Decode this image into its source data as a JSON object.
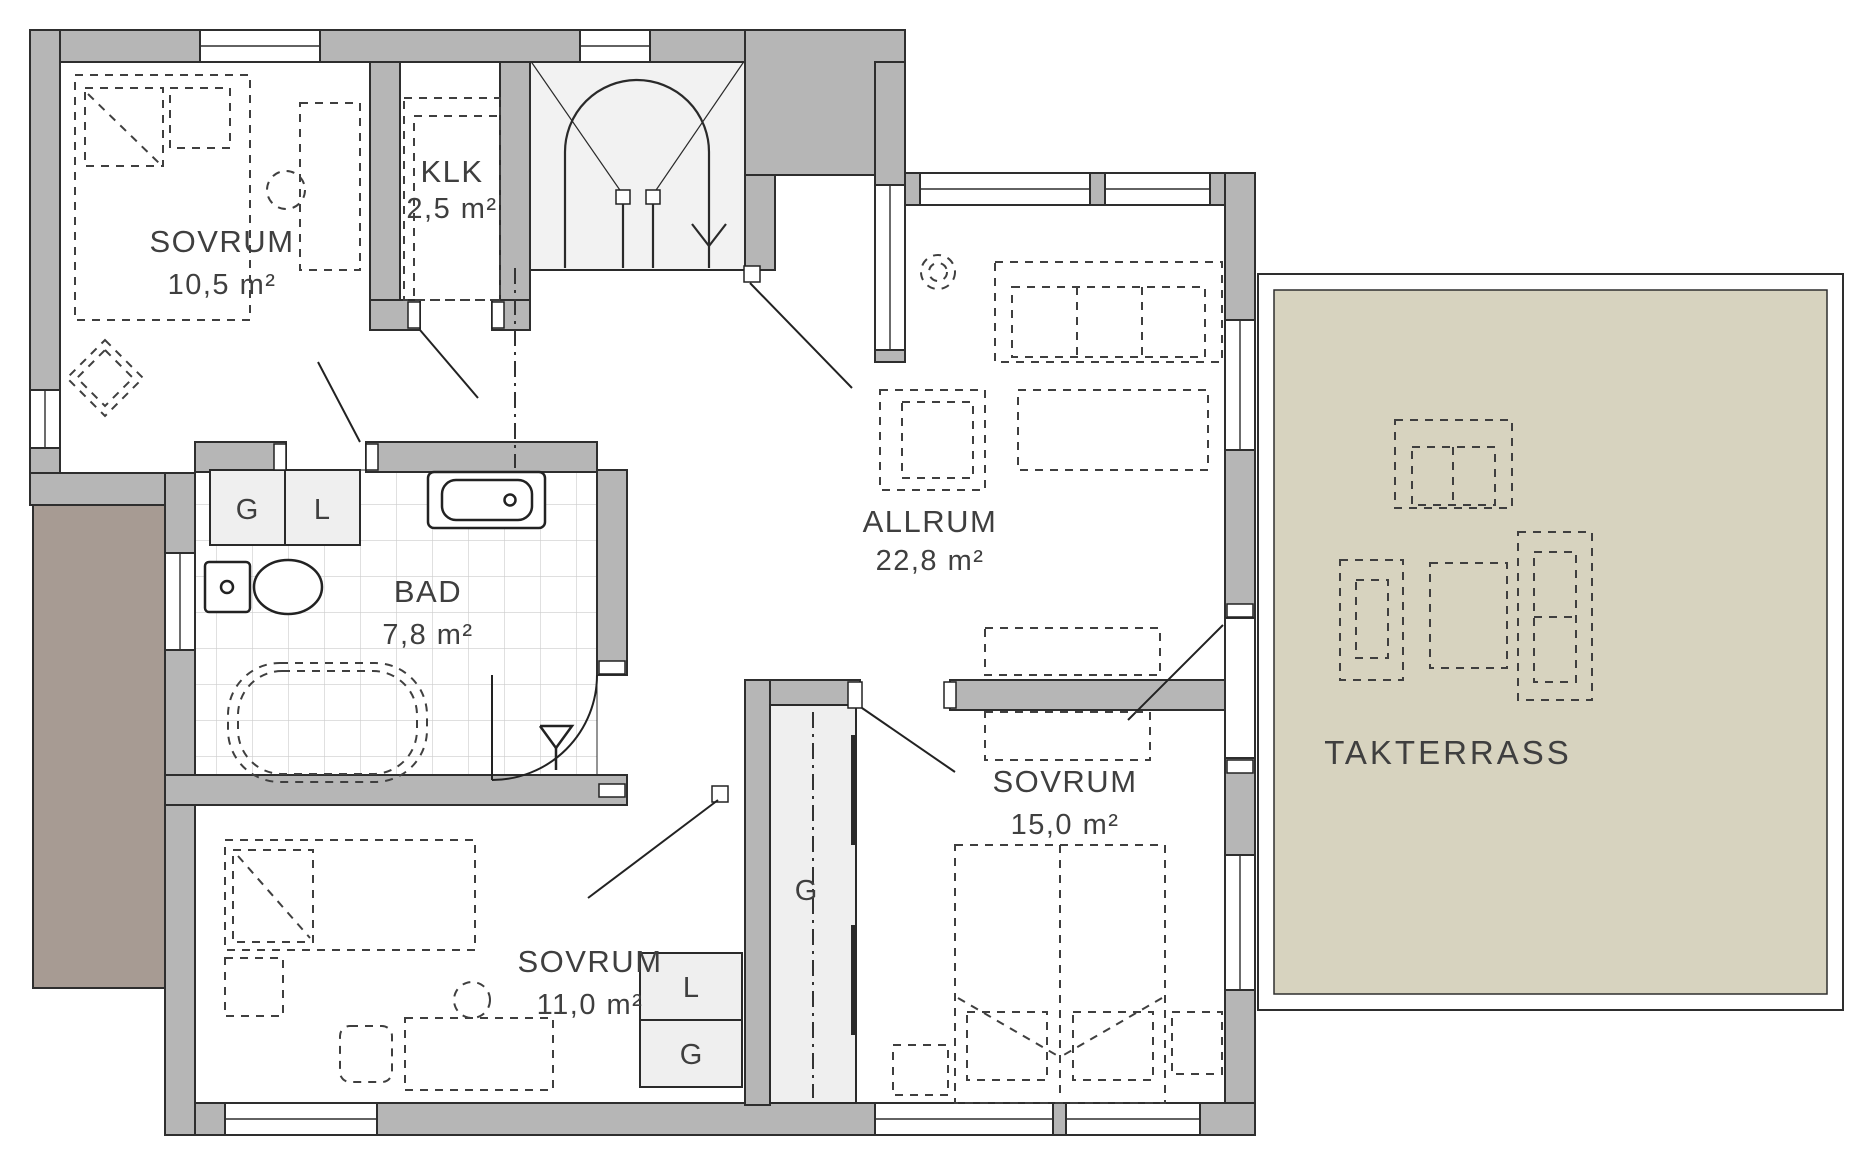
{
  "plan_title": "Floor plan, upper storey",
  "rooms": {
    "bedroom_top": {
      "name": "SOVRUM",
      "area": "10,5 m²"
    },
    "klk": {
      "name": "KLK",
      "area": "2,5 m²"
    },
    "living": {
      "name": "ALLRUM",
      "area": "22,8 m²"
    },
    "bath": {
      "name": "BAD",
      "area": "7,8 m²"
    },
    "bedroom_left": {
      "name": "SOVRUM",
      "area": "11,0 m²"
    },
    "bedroom_right": {
      "name": "SOVRUM",
      "area": "15,0 m²"
    },
    "terrace": {
      "name": "TAKTERRASS"
    }
  },
  "wardrobes": {
    "g_bath": "G",
    "l_bath": "L",
    "l_mid": "L",
    "g_mid": "G",
    "g_tall": "G"
  },
  "colors": {
    "wall": "#b6b6b6",
    "outline": "#2e2e2e",
    "room_floor": "#ffffff",
    "closet_floor": "#efefef",
    "terrace_floor": "#d7d3bf",
    "lower_roof": "#a79b93",
    "furniture_dash": "#3f3f3f",
    "tile_line": "#cccccc"
  }
}
